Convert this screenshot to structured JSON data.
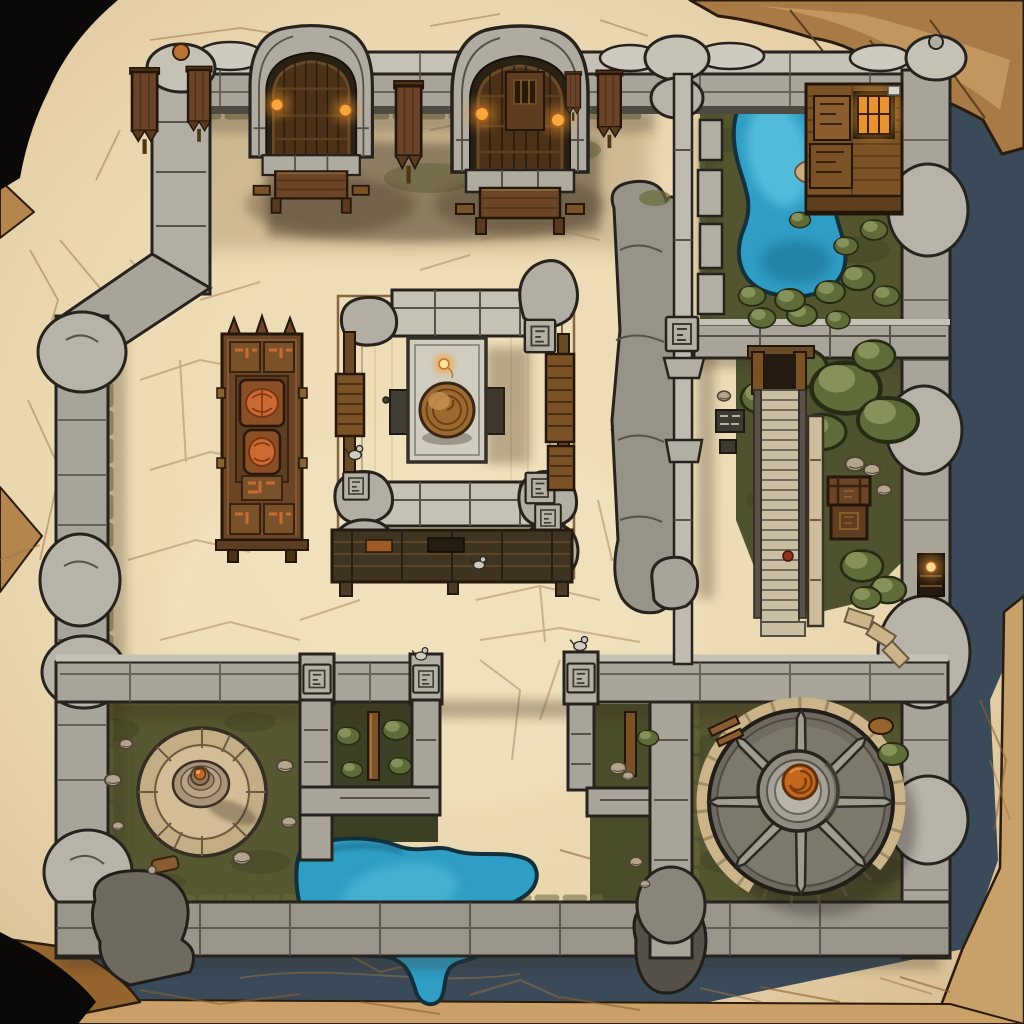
{
  "scene": {
    "type": "top-down fantasy battle map",
    "setting": "ruined stone fortress courtyard drawn on weathered torn parchment",
    "regions": [
      {
        "id": "north-gatehouses",
        "label": "Twin arched stone gatehouses with wooden gates, lit braziers and tables"
      },
      {
        "id": "northeast-pond-garden",
        "label": "Walled garden with blue kidney pond, bushes and timber cabin with lit window"
      },
      {
        "id": "central-shrine",
        "label": "Central shrine deck with stone altar table, candle flame and bronze coiled dome"
      },
      {
        "id": "west-carved-cabinet",
        "label": "Ornate carved wooden cabinet with orange relief medallions"
      },
      {
        "id": "east-garden",
        "label": "Tree garden with long descending staircase and banded supply chest"
      },
      {
        "id": "southwest-fountain",
        "label": "Grass yard with circular stone dais and ringed spire"
      },
      {
        "id": "south-pen",
        "label": "Stone-fenced pen with upright timber beam and shrubs"
      },
      {
        "id": "south-pool",
        "label": "Teal pool with flagstone shore and southern outflow"
      },
      {
        "id": "southeast-wheel",
        "label": "Great eight-spoked stone wheel mechanism with orange spiral hub"
      },
      {
        "id": "curtain-walls",
        "label": "Gray stone curtain walls with pillars, rune plaques, banners, bird statues and a lit alcove"
      }
    ],
    "counts": {
      "gatehouses": 2,
      "brazier_lamps": 4,
      "wall_banners": 4,
      "wheel_spokes": 8,
      "bird_statues": 4,
      "rune_plaques": 9,
      "water_bodies": 2
    }
  },
  "colors": {
    "void": "#0b0907",
    "rock_edge": "#a87a46",
    "rock_light": "#c69c64",
    "parchment": "#e9d6ae",
    "parchment_light": "#f2e4c2",
    "parchment_dark": "#d7bc92",
    "crack": "#9c7848",
    "shadow_band": "#3a4a59",
    "stone_light": "#c6c1b5",
    "stone": "#a9a49a",
    "stone_dark": "#6e695e",
    "outline": "#26231e",
    "grass": "#53552f",
    "grass_dark": "#3b3f24",
    "moss": "#6a6b3a",
    "bush": "#5f6b38",
    "bush_light": "#86925a",
    "water": "#2f9dc4",
    "water_light": "#5cc2de",
    "water_deep": "#1d6f94",
    "wood": "#6b4526",
    "wood_dark": "#241709",
    "wood_light": "#8a6335",
    "plank": "#7a5226",
    "glow": "#f5a83c",
    "glow_bright": "#ffd98f",
    "carving": "#cc6a33",
    "dome": "#9c6a30",
    "wheel_core": "#c4671e"
  }
}
